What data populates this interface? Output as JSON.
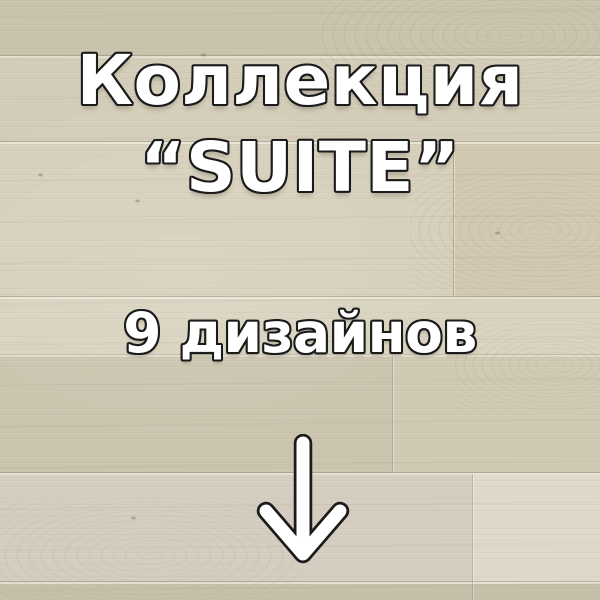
{
  "overlay": {
    "title_line1": "Коллекция",
    "title_line2": "“SUITE”",
    "subtitle": "9 дизайнов",
    "text_color": "#ffffff",
    "text_outline_color": "#1b1b1b",
    "arrow": {
      "icon": "down-arrow-icon",
      "fill_color": "#ffffff",
      "outline_color": "#1b1b1b"
    }
  },
  "background": {
    "surface": "wood-laminate-plank-floor",
    "base_color": "#d2ccb8",
    "plank_colors": [
      "#c9c4ae",
      "#d3cdb9",
      "#d6d0bc",
      "#d9d3c0",
      "#d0cab5",
      "#d5cec0",
      "#c6c0ab"
    ],
    "seam_color": "#68604e"
  }
}
